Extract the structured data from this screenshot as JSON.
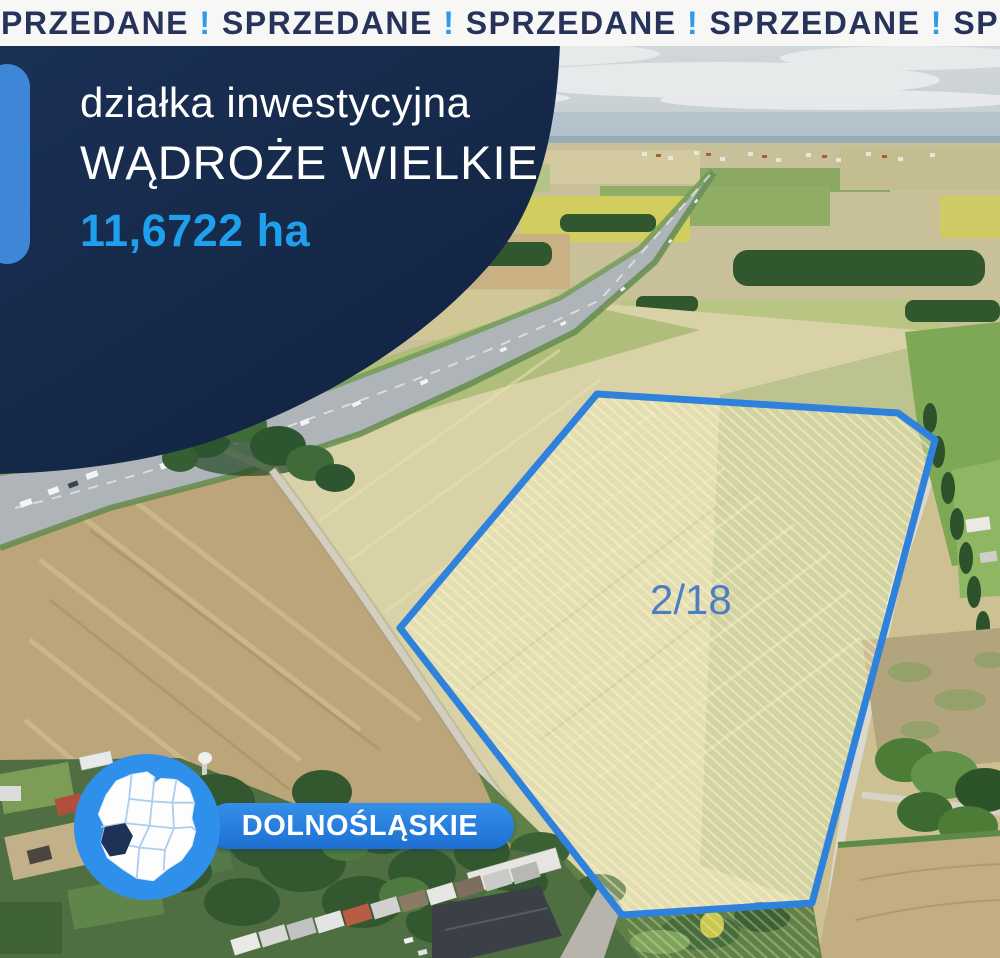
{
  "banner": {
    "visible_text": "PRZEDANE ! SPRZEDANE ! SPRZEDANE ! SPRZEDANE ! SP",
    "word_color": "#27335a",
    "exclamation_color": "#2d9ceb",
    "background": "#f7f8f6"
  },
  "card": {
    "subtitle": "działka inwestycyjna",
    "title": "WĄDROŻE WIELKIE",
    "area": "11,6722 ha",
    "background_color": "#16294b",
    "area_color": "#1fa0ec",
    "accent_color": "#3d86d8"
  },
  "parcel": {
    "label": "2/18",
    "outline_color": "#2f82dc",
    "label_color": "#4d7fc0"
  },
  "region": {
    "label": "DOLNOŚLĄSKIE",
    "pill_color_top": "#3490e8",
    "pill_color_bottom": "#1d6fd2",
    "map_circle_color": "#2e90ea",
    "map_highlight_color": "#1d3256"
  }
}
